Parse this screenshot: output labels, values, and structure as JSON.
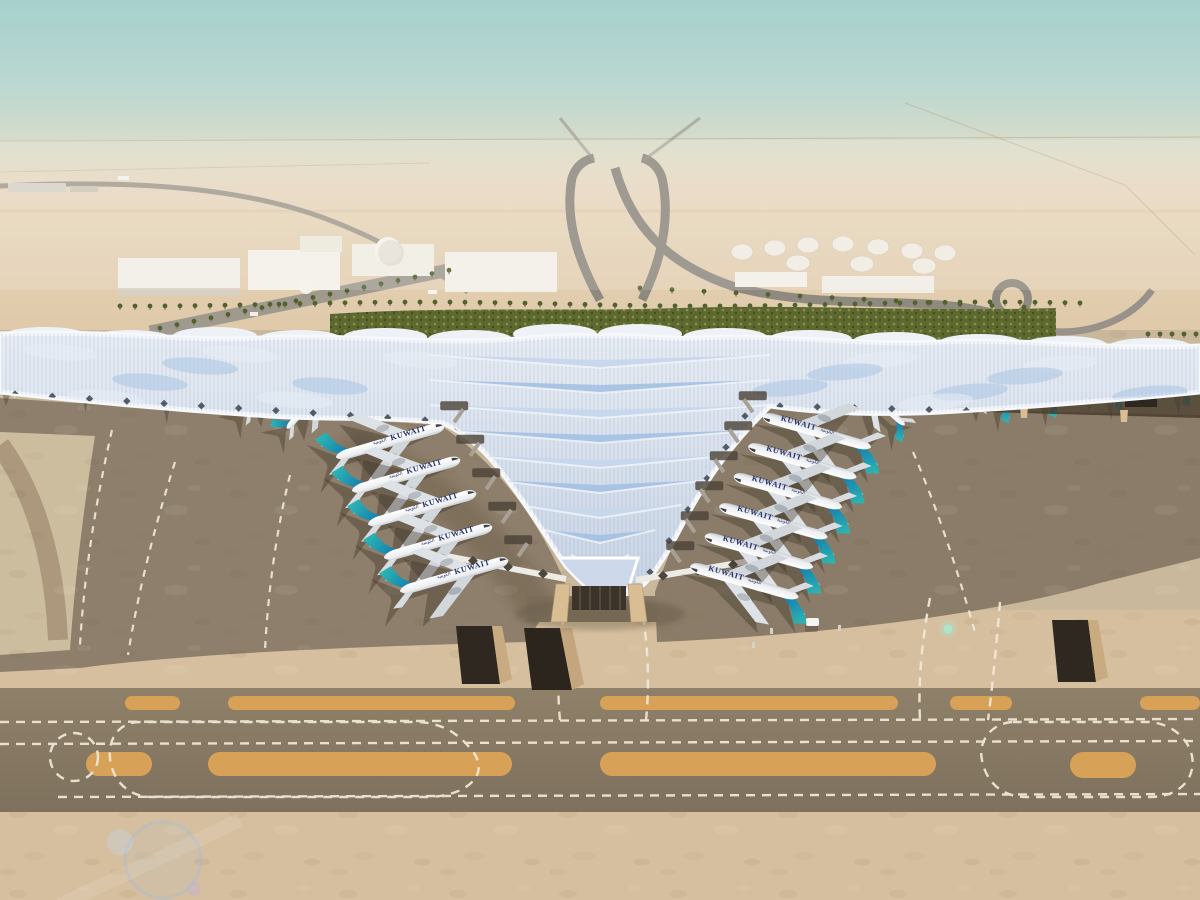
{
  "scene": {
    "livery": {
      "wordmark": "KUWAIT",
      "wordmark_arabic": "الكويتية",
      "text_color": "#23306e"
    },
    "aircraft_counts": {
      "left_concourse_bay": 5,
      "right_concourse_bay": 6,
      "left_wing_gates": 5,
      "right_wing_gates": 5
    },
    "palette": {
      "sky_top": "#a6d0cd",
      "sky_haze": "#e9dac4",
      "desert": "#e0cbab",
      "sand": "#d6bf9e",
      "roof_white": "#f0f3f7",
      "roof_glass": "#9dbcdf",
      "hedge_green": "#5d682f",
      "apron_light": "#c9b89c",
      "apron_dark": "#8d7f6b",
      "taxiway_band": "#857661",
      "shoulder_yellow": "#d7a258",
      "marking_white": "#f1ead9",
      "tail_teal": "#2fbdb3",
      "tail_blue": "#0f6fae",
      "fascia_tan": "#c8a678"
    }
  }
}
